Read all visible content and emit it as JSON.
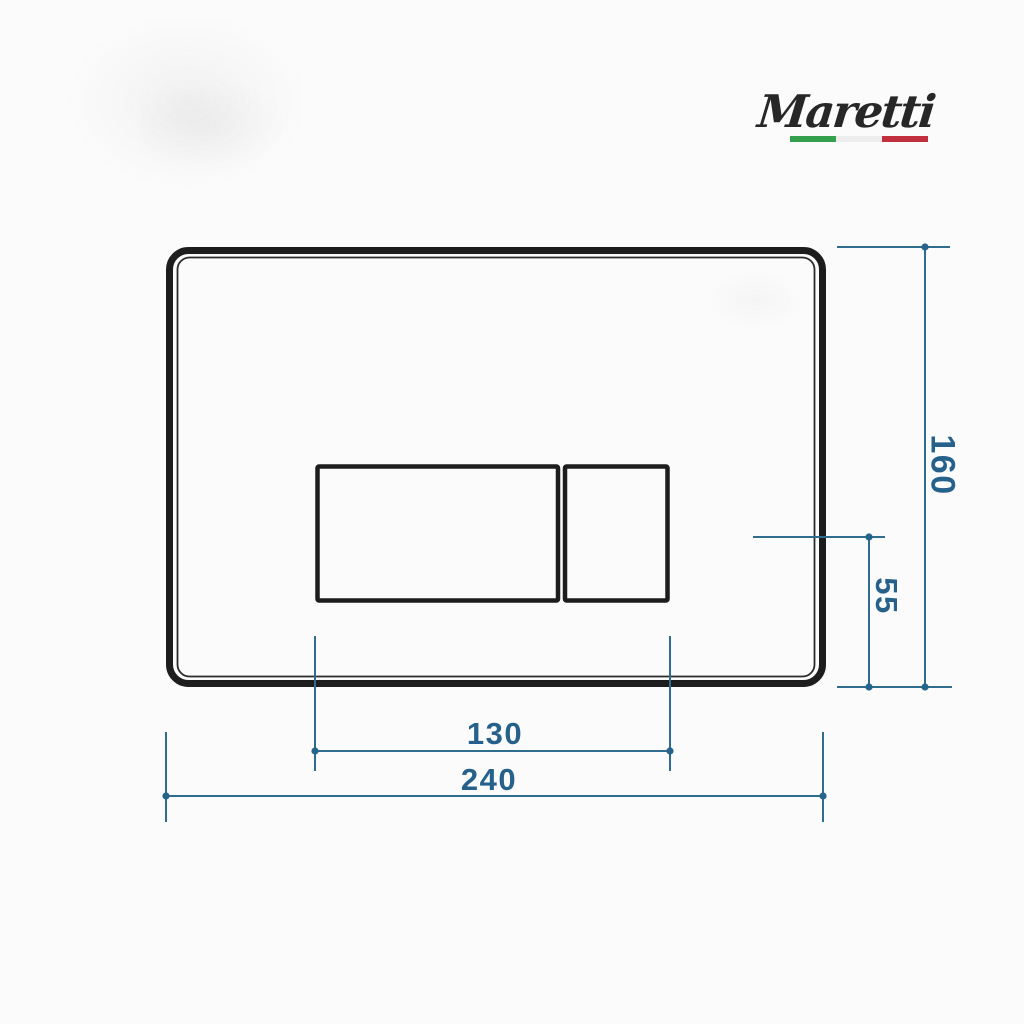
{
  "page": {
    "background": "#fbfbfb"
  },
  "brand": {
    "name": "Maretti",
    "text_color": "#272727",
    "flag_colors": {
      "green": "#35a04e",
      "white": "#ededed",
      "red": "#c22f3e"
    }
  },
  "drawing": {
    "type": "technical-dimension-drawing",
    "outline_color": "#1d1d1d",
    "dimension_line_color": "#2f6d8f",
    "dimension_text_color": "#26618b",
    "dimensions": {
      "plate_width": "240",
      "plate_height": "160",
      "buttons_width": "130",
      "button_bottom_offset": "55"
    }
  }
}
